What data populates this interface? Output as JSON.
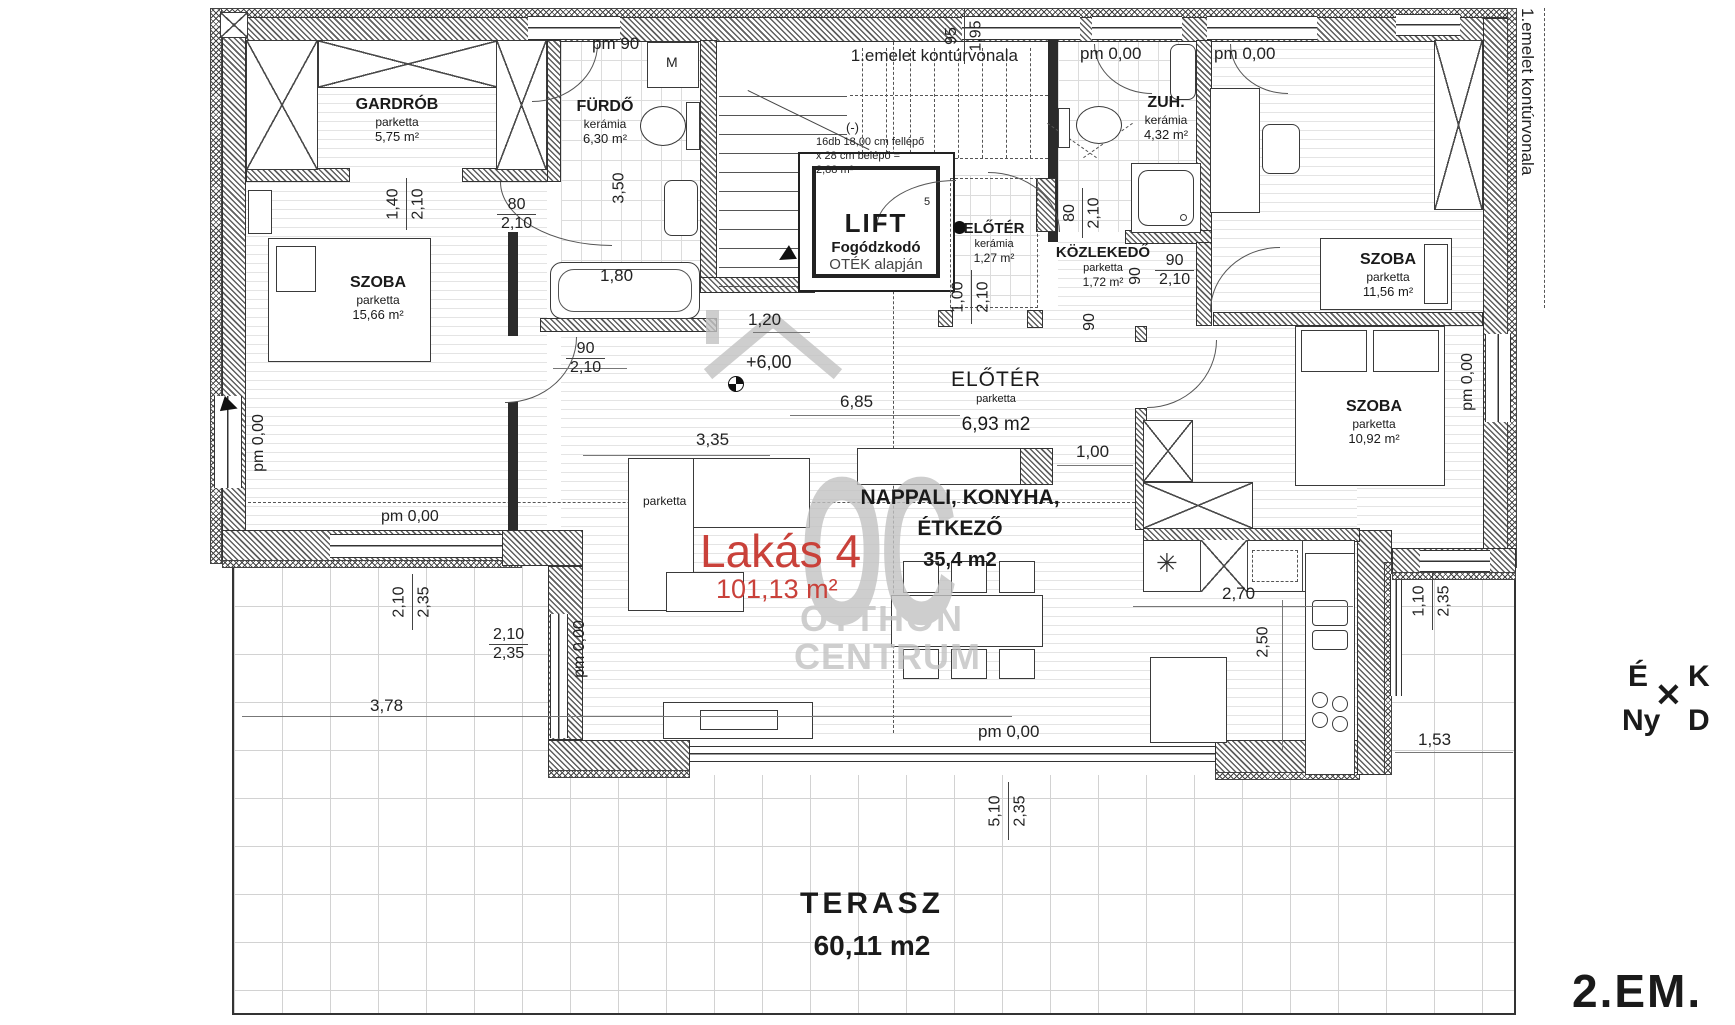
{
  "floor_label": "2.EM.",
  "apartment": {
    "name": "Lakás 4",
    "area": "101,13 m²"
  },
  "colors": {
    "accent_red": "#c9413a",
    "watermark_gray": "#c2c2c2"
  },
  "rooms": {
    "gardrob": {
      "name": "GARDRÓB",
      "finish": "parketta",
      "area": "5,75 m²"
    },
    "furdo": {
      "name": "FÜRDŐ",
      "finish": "kerámia",
      "area": "6,30 m²"
    },
    "szoba_nw": {
      "name": "SZOBA",
      "finish": "parketta",
      "area": "15,66 m²"
    },
    "eloter_kis": {
      "name": "ELŐTÉR",
      "finish": "kerámia",
      "area": "1,27 m²"
    },
    "kozlekedo": {
      "name": "KÖZLEKEDŐ",
      "finish": "parketta",
      "area": "1,72 m²"
    },
    "zuhanyzo": {
      "name": "ZUH.",
      "finish": "kerámia",
      "area": "4,32 m²"
    },
    "szoba_ne": {
      "name": "SZOBA",
      "finish": "parketta",
      "area": "11,56 m²"
    },
    "szoba_se": {
      "name": "SZOBA",
      "finish": "parketta",
      "area": "10,92 m²"
    },
    "eloter_nagy": {
      "name": "ELŐTÉR",
      "finish": "parketta",
      "area": "6,93 m2"
    },
    "nappali": {
      "line1": "NAPPALI, KONYHA,",
      "line2": "ÉTKEZŐ",
      "area": "35,4 m2"
    },
    "terasz": {
      "name": "TERASZ",
      "area": "60,11 m2"
    }
  },
  "lift": {
    "title": "LIFT",
    "sub1": "Fogódzkodó",
    "sub2": "OTÉK alapján"
  },
  "stairs": {
    "line1": "16db 18,00 cm fellépő",
    "line2": "x 28 cm belépő =",
    "line3": "2,88 m²",
    "mark": "(-)",
    "step": "5"
  },
  "labels": {
    "washer": "M",
    "sofa_finish": "parketta",
    "level": "+6,00",
    "contour": "1.emelet kontúrvonala",
    "appliance_symbol": "✳",
    "cross": "✕"
  },
  "compass": {
    "n": "É",
    "e": "K",
    "w": "Ny",
    "s": "D"
  },
  "watermark": {
    "logo": "OC",
    "line1": "OTTHON",
    "line2": "CENTRUM"
  },
  "dims": {
    "pm90": "pm 90",
    "pm0": "pm 0,00",
    "d80": "80",
    "d90": "90",
    "d95": "95",
    "d100": "1,00",
    "d110": "1,10",
    "d120": "1,20",
    "d140": "1,40",
    "d153": "1,53",
    "d180": "1,80",
    "d195": "1,95",
    "d210": "2,10",
    "d235": "2,35",
    "d250": "2,50",
    "d270": "2,70",
    "d335": "3,35",
    "d350": "3,50",
    "d378": "3,78",
    "d510": "5,10",
    "d685": "6,85"
  }
}
